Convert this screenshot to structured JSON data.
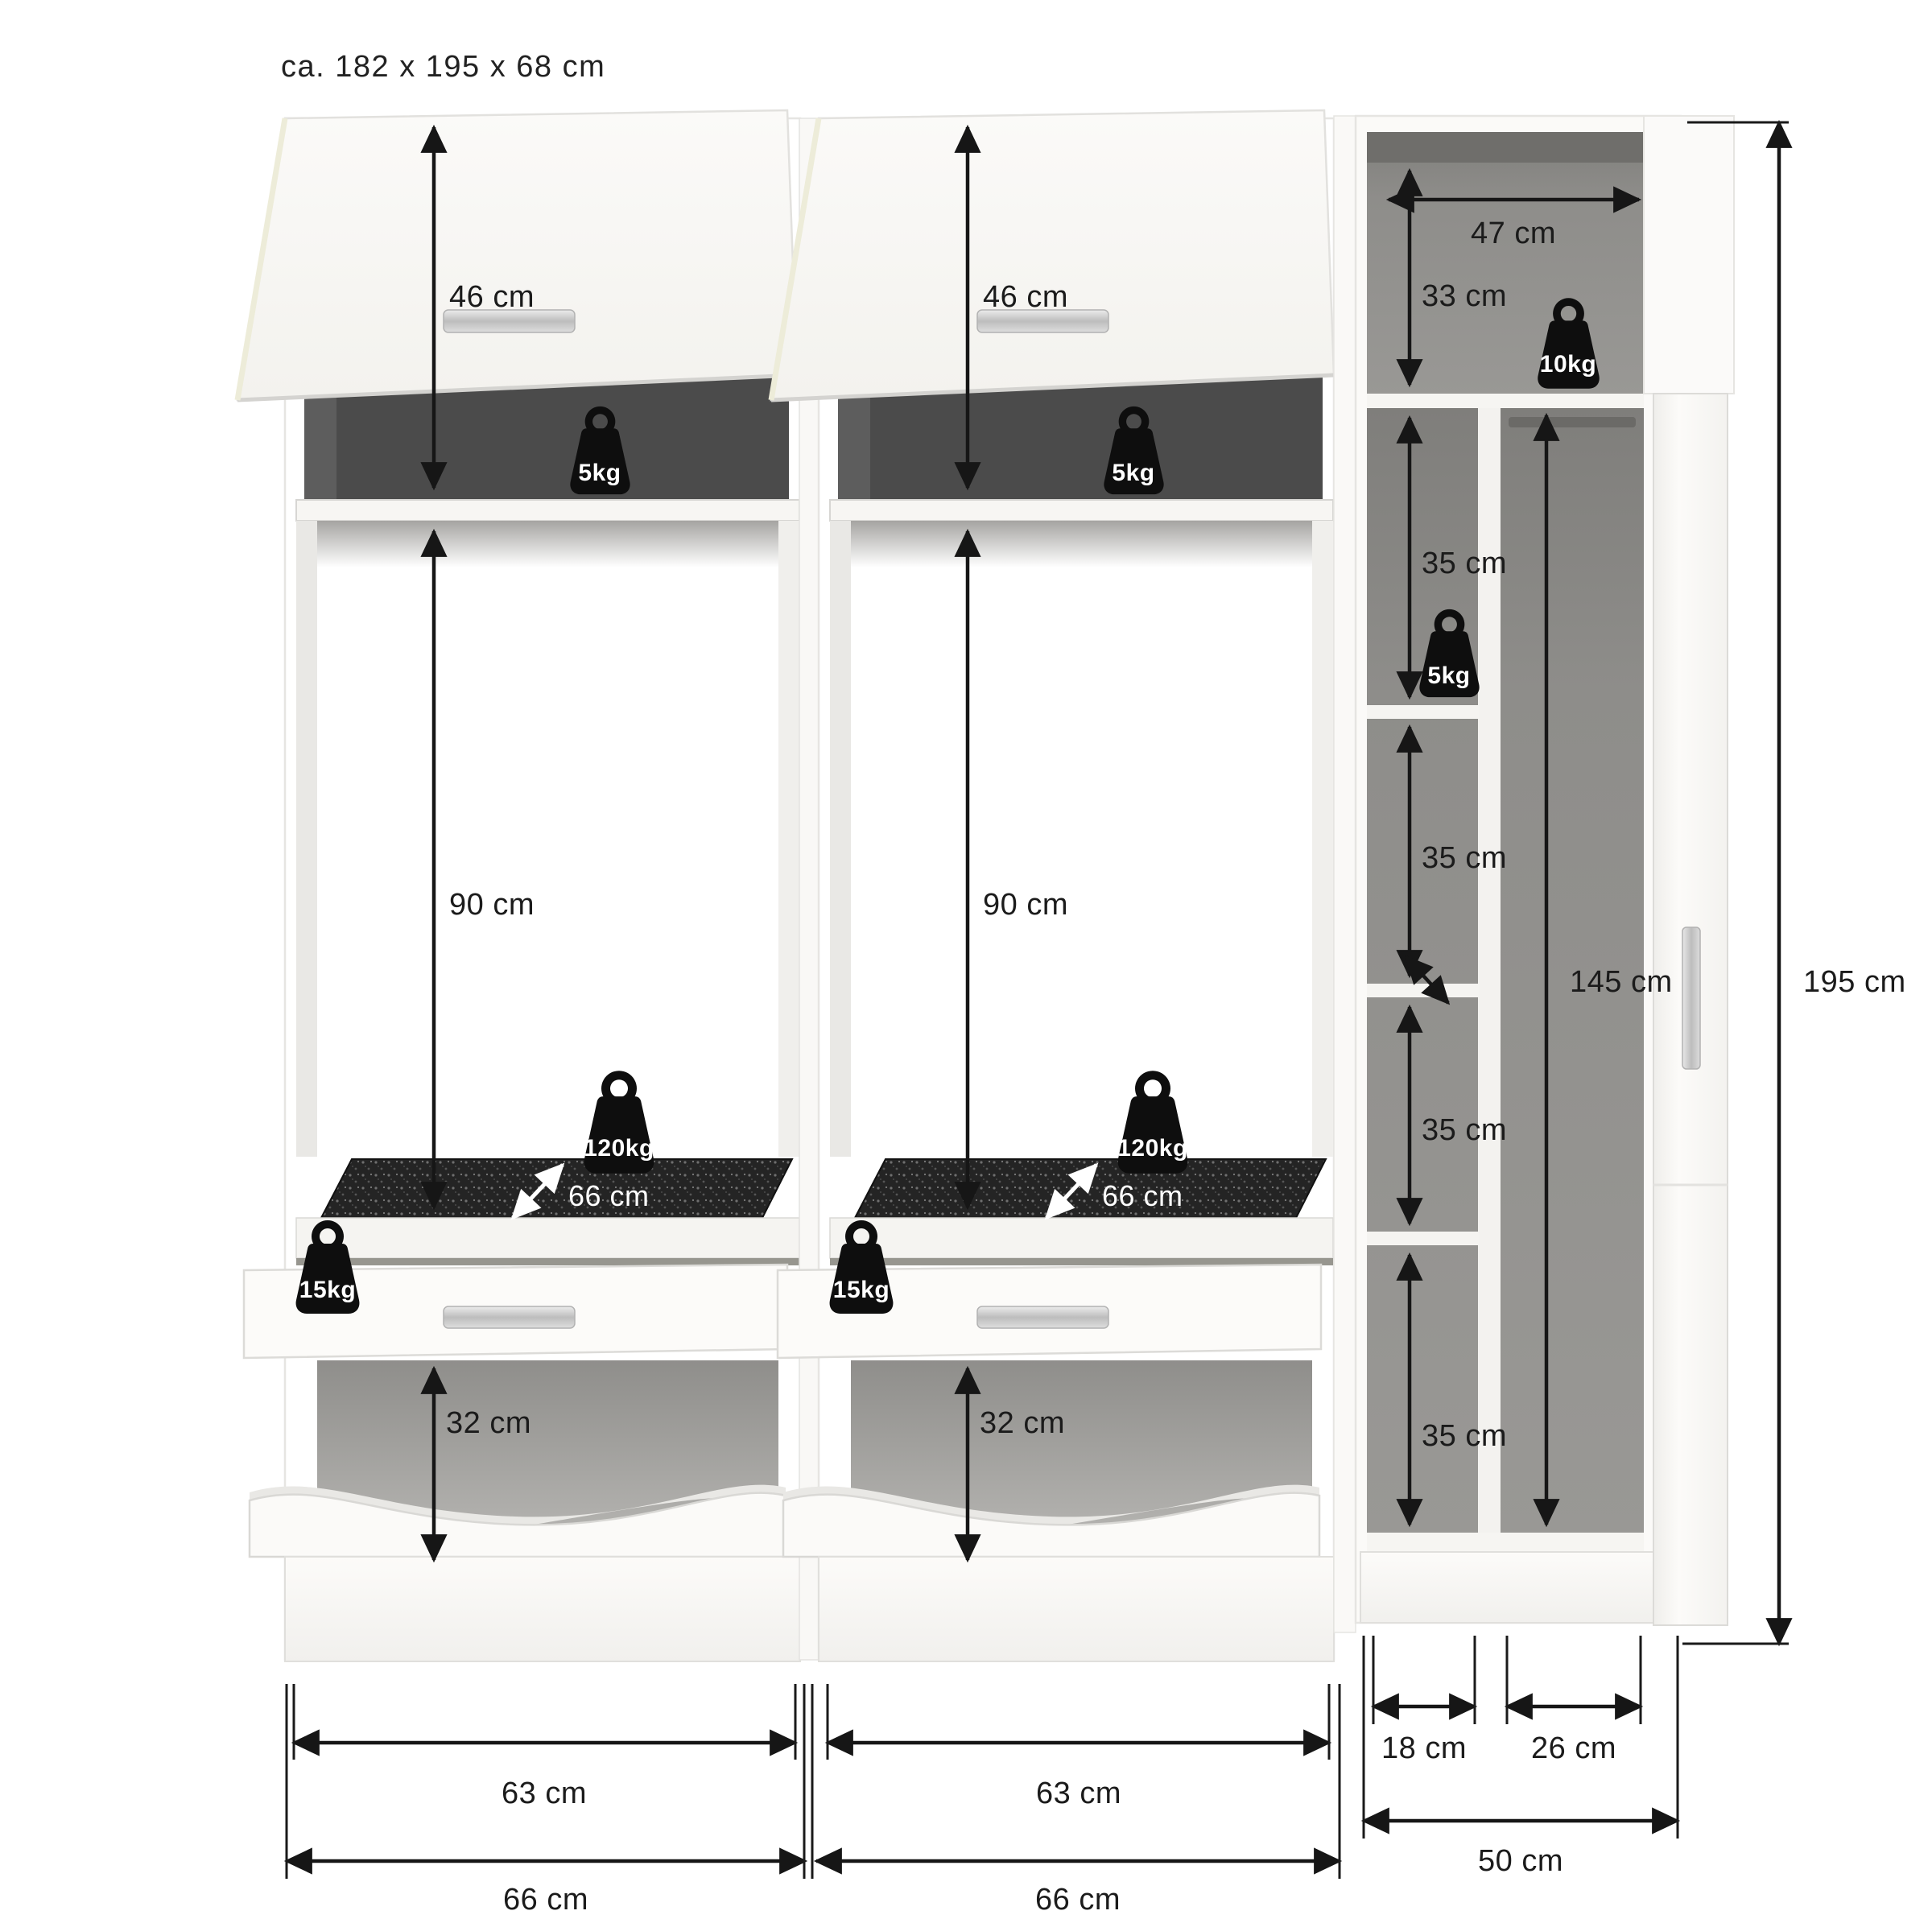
{
  "title": "ca. 182 x 195 x 68 cm",
  "overall": {
    "height": "195 cm"
  },
  "colors": {
    "line": "#1a1a1a",
    "interior_dark": "#4b4b4b",
    "interior_gray": "#8e8d8a",
    "mat": "#242424",
    "surface": "#faf9f7",
    "handle": "#c9c9c9"
  },
  "left_unit": {
    "flap_height": "46 cm",
    "top_shelf_load": "5kg",
    "niche_height": "90 cm",
    "appliance_shelf_load": "120kg",
    "appliance_shelf_depth": "66 cm",
    "drawer_load": "15kg",
    "bin_niche_height": "32 cm",
    "inner_width": "63 cm",
    "outer_width": "66 cm"
  },
  "middle_unit": {
    "flap_height": "46 cm",
    "top_shelf_load": "5kg",
    "niche_height": "90 cm",
    "appliance_shelf_load": "120kg",
    "appliance_shelf_depth": "66 cm",
    "drawer_load": "15kg",
    "bin_niche_height": "32 cm",
    "inner_width": "63 cm",
    "outer_width": "66 cm"
  },
  "right_unit": {
    "top_niche_width": "47 cm",
    "top_niche_height": "33 cm",
    "top_niche_load": "10kg",
    "shelf_load": "5kg",
    "compartments": [
      "35 cm",
      "35 cm",
      "35 cm",
      "35 cm"
    ],
    "hanging_height": "145 cm",
    "shelf_column_width": "18 cm",
    "hanging_column_width": "26 cm",
    "outer_width": "50 cm"
  }
}
